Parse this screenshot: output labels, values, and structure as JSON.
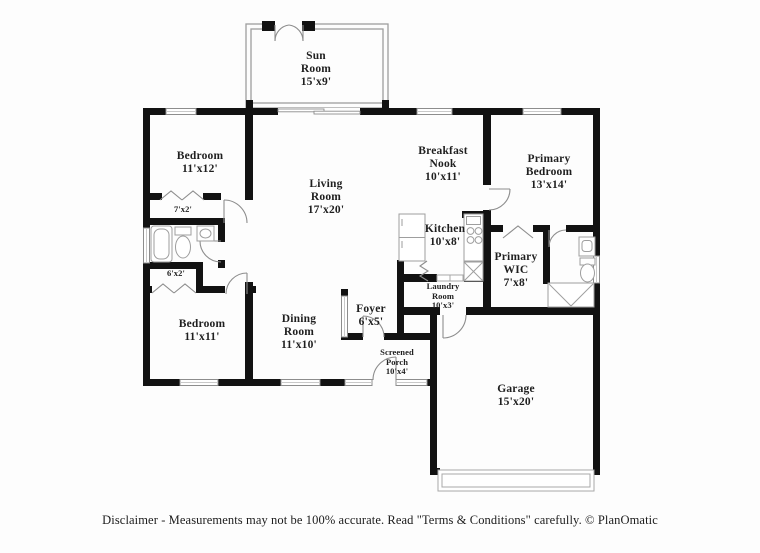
{
  "page": {
    "background": "#fdfdfd"
  },
  "colors": {
    "wall": "#121212",
    "window_frame": "#8d8d8d",
    "door_arc": "#8d8d8d",
    "fixture_outline": "#9e9e9e",
    "label_text": "#1f1f1f"
  },
  "rooms": [
    {
      "name": "Sun Room",
      "dims": "15'x9'"
    },
    {
      "name": "Bedroom",
      "dims": "11'x12'"
    },
    {
      "name": "",
      "dims": "7'x2'"
    },
    {
      "name": "",
      "dims": "6'x2'"
    },
    {
      "name": "Bedroom",
      "dims": "11'x11'"
    },
    {
      "name": "Living Room",
      "dims": "17'x20'"
    },
    {
      "name": "Dining Room",
      "dims": "11'x10'"
    },
    {
      "name": "Foyer",
      "dims": "6'x5'"
    },
    {
      "name": "Screened Porch",
      "dims": "10'x4'"
    },
    {
      "name": "Breakfast Nook",
      "dims": "10'x11'"
    },
    {
      "name": "Kitchen",
      "dims": "10'x8'"
    },
    {
      "name": "Laundry Room",
      "dims": "10'x3'"
    },
    {
      "name": "Primary Bedroom",
      "dims": "13'x14'"
    },
    {
      "name": "Primary WIC",
      "dims": "7'x8'"
    },
    {
      "name": "Garage",
      "dims": "15'x20'"
    }
  ],
  "fixtures": [
    "bathtub",
    "toilet",
    "sink",
    "shower",
    "refrigerator",
    "stove",
    "dishwasher",
    "garage-door",
    "french-doors",
    "sliding-door",
    "bifold-closet-doors",
    "windows"
  ],
  "footer": {
    "disclaimer": "Disclaimer - Measurements may not be 100% accurate. Read \"Terms & Conditions\" carefully. © PlanOmatic"
  }
}
